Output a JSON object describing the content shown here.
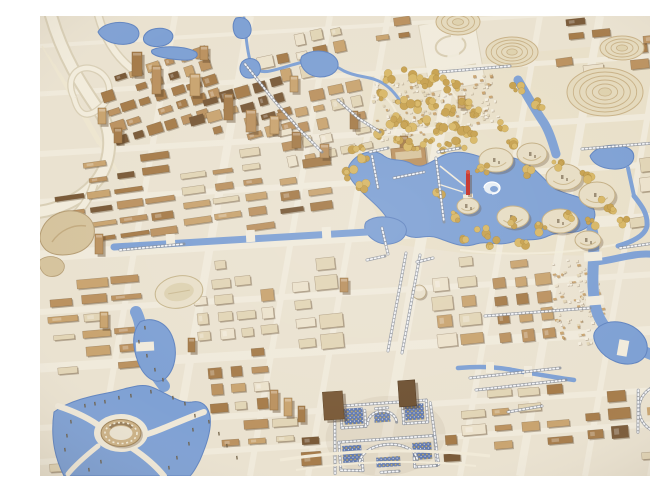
{
  "meta": {
    "subject": "Photograph of an architectural scale model of a city master plan, viewed from above at an angle",
    "width": 650,
    "height": 460
  },
  "palette": {
    "base": "#eae2d0",
    "base2": "#efe8d7",
    "road": "#f1ebdc",
    "park": "#e9e0c9",
    "tan": "#c9a470",
    "tan2": "#bb9260",
    "brown": "#a67c4a",
    "brown2": "#7a5a38",
    "cream": "#e2d5b6",
    "white": "#ece2cc",
    "water": "#7fa1d4",
    "waterEdge": "#6285c0",
    "gold": "#d8b766",
    "gold2": "#c7a14f",
    "silver": "#c8cbd3",
    "silverDark": "#878d99",
    "mosaic": "#5470ac",
    "mosaicGold": "#c9a84c",
    "red": "#c22f28"
  },
  "features": [
    "highway-interchange",
    "rail-tracks",
    "old-town-cluster",
    "central-lake",
    "lake-swirl",
    "red-tower-landmark",
    "mound-pavilions",
    "terraced-hill",
    "oval-terraced-building",
    "gold-tree-park",
    "village-on-terraces",
    "central-axis-promenade",
    "palace-complex",
    "arc-colonnade-landmark",
    "ring-building",
    "stadium-field",
    "lagoon",
    "rivers-and-canals"
  ],
  "streets": {
    "lean": 80,
    "drop": 40,
    "verticals": [
      [
        55,
        6
      ],
      [
        130,
        8
      ],
      [
        210,
        6
      ],
      [
        268,
        6
      ],
      [
        340,
        11
      ],
      [
        420,
        6
      ],
      [
        480,
        8
      ],
      [
        545,
        6
      ],
      [
        610,
        6
      ]
    ],
    "horizontals": [
      [
        30,
        4
      ],
      [
        78,
        5
      ],
      [
        138,
        6
      ],
      [
        186,
        6
      ],
      [
        240,
        11
      ],
      [
        296,
        6
      ],
      [
        352,
        9
      ],
      [
        412,
        6
      ],
      [
        446,
        6
      ]
    ],
    "rails": [
      2,
      30,
      58,
      128,
      6,
      6,
      9
    ]
  },
  "fields": [
    [
      62,
      42,
      7,
      5,
      17,
      15,
      12,
      8,
      -18,
      "brown",
      11
    ],
    [
      150,
      70,
      6,
      4,
      17,
      15,
      12,
      8,
      -16,
      "brown",
      12
    ],
    [
      215,
      15,
      5,
      3,
      19,
      16,
      13,
      9,
      -12,
      "mixed",
      13
    ],
    [
      235,
      70,
      5,
      5,
      19,
      15,
      13,
      8,
      -12,
      "mixed",
      14
    ],
    [
      330,
      0,
      2,
      2,
      22,
      14,
      15,
      7,
      -8,
      "brown",
      15
    ],
    [
      500,
      0,
      3,
      2,
      24,
      13,
      17,
      6,
      -6,
      "brown",
      16
    ],
    [
      540,
      26,
      4,
      2,
      24,
      15,
      17,
      8,
      -6,
      "mixed",
      17
    ],
    [
      510,
      24,
      1,
      2,
      26,
      15,
      19,
      7,
      -8,
      "brown",
      18
    ],
    [
      568,
      140,
      2,
      2,
      30,
      20,
      24,
      14,
      -7,
      "cream",
      19
    ],
    [
      585,
      180,
      2,
      2,
      26,
      16,
      19,
      8,
      -8,
      "cream",
      20
    ],
    [
      15,
      138,
      4,
      6,
      30,
      15,
      24,
      6,
      -8,
      "brown",
      21
    ],
    [
      140,
      132,
      3,
      6,
      30,
      15,
      23,
      6,
      -8,
      "tan",
      22
    ],
    [
      235,
      140,
      2,
      5,
      30,
      15,
      23,
      7,
      -8,
      "brown",
      23
    ],
    [
      8,
      258,
      3,
      6,
      32,
      17,
      25,
      7,
      -5,
      "tan",
      24
    ],
    [
      44,
      366,
      2,
      2,
      28,
      16,
      20,
      7,
      -4,
      "tan",
      25
    ],
    [
      150,
      240,
      4,
      5,
      22,
      17,
      15,
      10,
      -6,
      "cream",
      26
    ],
    [
      165,
      330,
      3,
      4,
      22,
      17,
      15,
      9,
      -5,
      "mixed",
      27
    ],
    [
      250,
      240,
      2,
      5,
      26,
      19,
      19,
      12,
      -6,
      "cream",
      28
    ],
    [
      390,
      238,
      2,
      5,
      26,
      19,
      19,
      12,
      -6,
      "cream",
      29
    ],
    [
      450,
      238,
      3,
      5,
      22,
      18,
      15,
      10,
      -7,
      "brown",
      30
    ],
    [
      175,
      400,
      3,
      2,
      28,
      16,
      21,
      7,
      -4,
      "tan",
      31
    ],
    [
      420,
      368,
      4,
      4,
      28,
      17,
      20,
      8,
      -5,
      "mixed",
      32
    ],
    [
      540,
      372,
      2,
      3,
      26,
      18,
      18,
      10,
      -5,
      "brown",
      33
    ],
    [
      6,
      430,
      2,
      2,
      20,
      14,
      14,
      6,
      -3,
      "tan",
      34
    ],
    [
      258,
      398,
      1,
      3,
      24,
      18,
      16,
      10,
      -4,
      "brown",
      35
    ],
    [
      398,
      396,
      1,
      3,
      24,
      18,
      16,
      10,
      -4,
      "brown",
      36
    ],
    [
      625,
      66,
      1,
      3,
      24,
      16,
      16,
      9,
      -8,
      "brown",
      37
    ],
    [
      600,
      0,
      2,
      2,
      24,
      14,
      16,
      7,
      -6,
      "mixed",
      38
    ],
    [
      596,
      414,
      2,
      2,
      24,
      16,
      17,
      8,
      -4,
      "tan",
      39
    ]
  ],
  "villages": [
    [
      333,
      62,
      62,
      58,
      110,
      -8,
      41
    ],
    [
      398,
      60,
      57,
      50,
      85,
      -8,
      42
    ],
    [
      512,
      242,
      48,
      88,
      95,
      -10,
      43
    ]
  ],
  "towers": [
    [
      92,
      36,
      10,
      24
    ],
    [
      112,
      50,
      9,
      28
    ],
    [
      150,
      58,
      10,
      22
    ],
    [
      184,
      78,
      9,
      26
    ],
    [
      206,
      94,
      10,
      22
    ],
    [
      230,
      100,
      9,
      18
    ],
    [
      252,
      116,
      9,
      16
    ],
    [
      280,
      128,
      9,
      14
    ],
    [
      58,
      92,
      8,
      16
    ],
    [
      74,
      112,
      8,
      15
    ],
    [
      160,
      30,
      8,
      14
    ],
    [
      250,
      60,
      8,
      16
    ],
    [
      310,
      95,
      8,
      18
    ],
    [
      55,
      218,
      8,
      20
    ],
    [
      60,
      296,
      8,
      16
    ],
    [
      148,
      322,
      7,
      14
    ],
    [
      230,
      374,
      8,
      20
    ],
    [
      244,
      382,
      8,
      18
    ],
    [
      258,
      390,
      7,
      16
    ],
    [
      640,
      250,
      8,
      14
    ],
    [
      336,
      146,
      7,
      12
    ],
    [
      360,
      120,
      8,
      14
    ],
    [
      300,
      262,
      8,
      14
    ],
    [
      418,
      80,
      7,
      12
    ]
  ],
  "trees": [
    [
      352,
      62,
      6,
      5
    ],
    [
      368,
      58,
      6,
      5
    ],
    [
      384,
      66,
      6,
      5
    ],
    [
      398,
      60,
      6,
      5
    ],
    [
      412,
      70,
      6,
      5
    ],
    [
      344,
      80,
      6,
      5
    ],
    [
      360,
      86,
      5,
      4
    ],
    [
      376,
      92,
      6,
      5
    ],
    [
      392,
      88,
      5,
      4
    ],
    [
      408,
      94,
      6,
      5
    ],
    [
      424,
      88,
      5,
      4
    ],
    [
      436,
      96,
      6,
      5
    ],
    [
      352,
      104,
      6,
      5
    ],
    [
      368,
      110,
      5,
      4
    ],
    [
      384,
      106,
      5,
      4
    ],
    [
      398,
      112,
      6,
      5
    ],
    [
      412,
      108,
      5,
      4
    ],
    [
      426,
      114,
      6,
      5
    ],
    [
      340,
      118,
      5,
      4
    ],
    [
      356,
      124,
      5,
      4
    ],
    [
      372,
      130,
      6,
      5
    ],
    [
      388,
      126,
      5,
      4
    ],
    [
      404,
      132,
      6,
      5
    ],
    [
      420,
      128,
      5,
      4
    ],
    [
      436,
      120,
      5,
      4
    ],
    [
      318,
      132,
      6,
      4
    ],
    [
      326,
      142,
      6,
      4
    ],
    [
      312,
      158,
      6,
      4
    ],
    [
      322,
      170,
      6,
      4
    ],
    [
      444,
      154,
      7,
      5
    ],
    [
      488,
      158,
      6,
      4
    ],
    [
      518,
      150,
      6,
      4
    ],
    [
      548,
      162,
      8,
      6
    ],
    [
      566,
      190,
      8,
      6
    ],
    [
      552,
      208,
      7,
      5
    ],
    [
      532,
      200,
      6,
      4
    ],
    [
      502,
      212,
      6,
      4
    ],
    [
      472,
      208,
      6,
      4
    ],
    [
      442,
      216,
      6,
      4
    ],
    [
      414,
      200,
      6,
      4
    ],
    [
      398,
      178,
      5,
      3
    ],
    [
      424,
      224,
      5,
      4
    ],
    [
      452,
      228,
      5,
      4
    ],
    [
      482,
      226,
      5,
      4
    ],
    [
      584,
      204,
      6,
      4
    ],
    [
      470,
      128,
      5,
      4
    ],
    [
      476,
      74,
      6,
      4
    ],
    [
      498,
      88,
      5,
      4
    ],
    [
      460,
      110,
      5,
      4
    ]
  ],
  "dot_rows": [
    [
      [
        205,
        48
      ],
      [
        232,
        82
      ],
      [
        258,
        112
      ],
      [
        282,
        136
      ]
    ],
    [
      [
        298,
        84
      ],
      [
        318,
        102
      ],
      [
        340,
        116
      ]
    ],
    [
      [
        348,
        335
      ],
      [
        366,
        237
      ]
    ],
    [
      [
        362,
        337
      ],
      [
        380,
        239
      ]
    ],
    [
      [
        430,
        362
      ],
      [
        520,
        352
      ]
    ],
    [
      [
        436,
        374
      ],
      [
        526,
        364
      ]
    ],
    [
      [
        542,
        133
      ],
      [
        650,
        124
      ]
    ],
    [
      [
        468,
        396
      ],
      [
        502,
        390
      ]
    ],
    [
      [
        80,
        234
      ],
      [
        144,
        228
      ]
    ],
    [
      [
        396,
        142
      ],
      [
        404,
        206
      ]
    ],
    [
      [
        332,
        140
      ],
      [
        338,
        172
      ]
    ],
    [
      [
        354,
        162
      ],
      [
        384,
        156
      ]
    ],
    [
      [
        342,
        212
      ],
      [
        348,
        238
      ]
    ],
    [
      [
        445,
        300
      ],
      [
        550,
        292
      ]
    ],
    [
      [
        580,
        232
      ],
      [
        650,
        222
      ]
    ],
    [
      [
        327,
        244
      ],
      [
        345,
        240
      ]
    ],
    [
      [
        377,
        246
      ],
      [
        393,
        242
      ]
    ],
    [
      [
        330,
        136
      ],
      [
        348,
        132
      ]
    ],
    [
      [
        398,
        136
      ],
      [
        420,
        132
      ]
    ],
    [
      [
        400,
        56
      ],
      [
        470,
        50
      ]
    ]
  ],
  "mounds": {
    "plain": [
      [
        456,
        144,
        17,
        12
      ],
      [
        492,
        138,
        15,
        11
      ],
      [
        524,
        161,
        18,
        13
      ],
      [
        557,
        179,
        18,
        13
      ],
      [
        473,
        201,
        16,
        11
      ],
      [
        520,
        205,
        18,
        12
      ],
      [
        428,
        190,
        11,
        8
      ],
      [
        548,
        224,
        13,
        9
      ]
    ],
    "ringed": [
      [
        565,
        76,
        38,
        24,
        5
      ],
      [
        582,
        32,
        22,
        12,
        3
      ],
      [
        472,
        36,
        26,
        15,
        4
      ],
      [
        418,
        6,
        22,
        13,
        3
      ]
    ]
  },
  "bollards": [
    [
      104,
      310
    ],
    [
      98,
      324
    ],
    [
      106,
      338
    ],
    [
      114,
      352
    ],
    [
      122,
      362
    ],
    [
      44,
      388
    ],
    [
      54,
      386
    ],
    [
      64,
      384
    ],
    [
      78,
      380
    ],
    [
      90,
      378
    ],
    [
      110,
      374
    ],
    [
      132,
      380
    ],
    [
      144,
      386
    ],
    [
      154,
      398
    ],
    [
      152,
      412
    ],
    [
      148,
      426
    ],
    [
      30,
      404
    ],
    [
      26,
      418
    ],
    [
      24,
      432
    ],
    [
      136,
      440
    ],
    [
      128,
      450
    ],
    [
      60,
      444
    ],
    [
      48,
      452
    ],
    [
      168,
      404
    ],
    [
      178,
      416
    ],
    [
      186,
      428
    ],
    [
      196,
      440
    ]
  ]
}
